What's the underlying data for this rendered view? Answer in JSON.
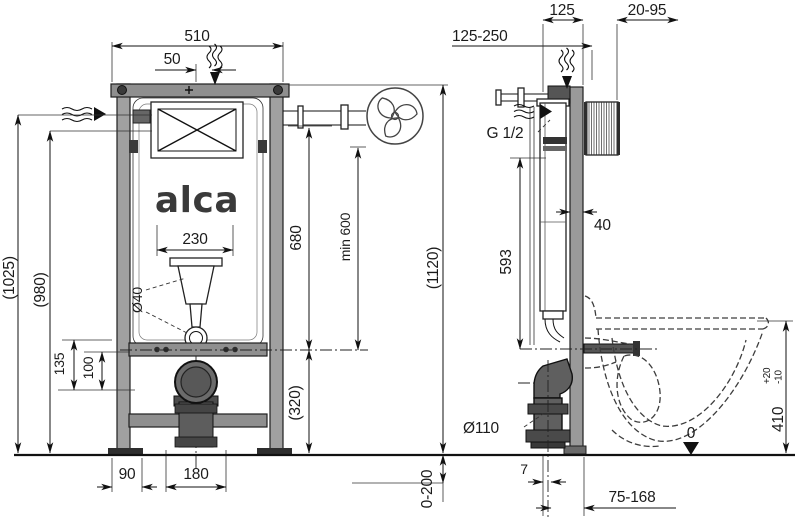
{
  "drawing": {
    "brand": "alca",
    "front_view": {
      "width_total": "510",
      "flush_offset": "50",
      "height_note_upper": "(1025)",
      "height_note_lower": "(980)",
      "bracket_dim_a": "135",
      "bracket_dim_b": "100",
      "cistern_width": "230",
      "flush_pipe_dia": "Ø40",
      "flush_pipe_height": "680",
      "min_height": "min 600",
      "frame_height": "(1120)",
      "drain_height": "(320)",
      "foot_width": "90",
      "drain_spacing": "180"
    },
    "side_view": {
      "depth_range": "125-250",
      "frame_depth": "125",
      "wall_finish_range": "20-95",
      "water_connection": "G 1/2",
      "connection_height": "593",
      "profile_depth": "40",
      "drain_dia": "Ø110",
      "bowl_height": "410",
      "bowl_tol_plus": "+20",
      "bowl_tol_minus": "-10",
      "floor_level": "0",
      "foot_gap": "7",
      "outlet_range": "75-168",
      "leg_adjust_range": "0-200"
    }
  }
}
